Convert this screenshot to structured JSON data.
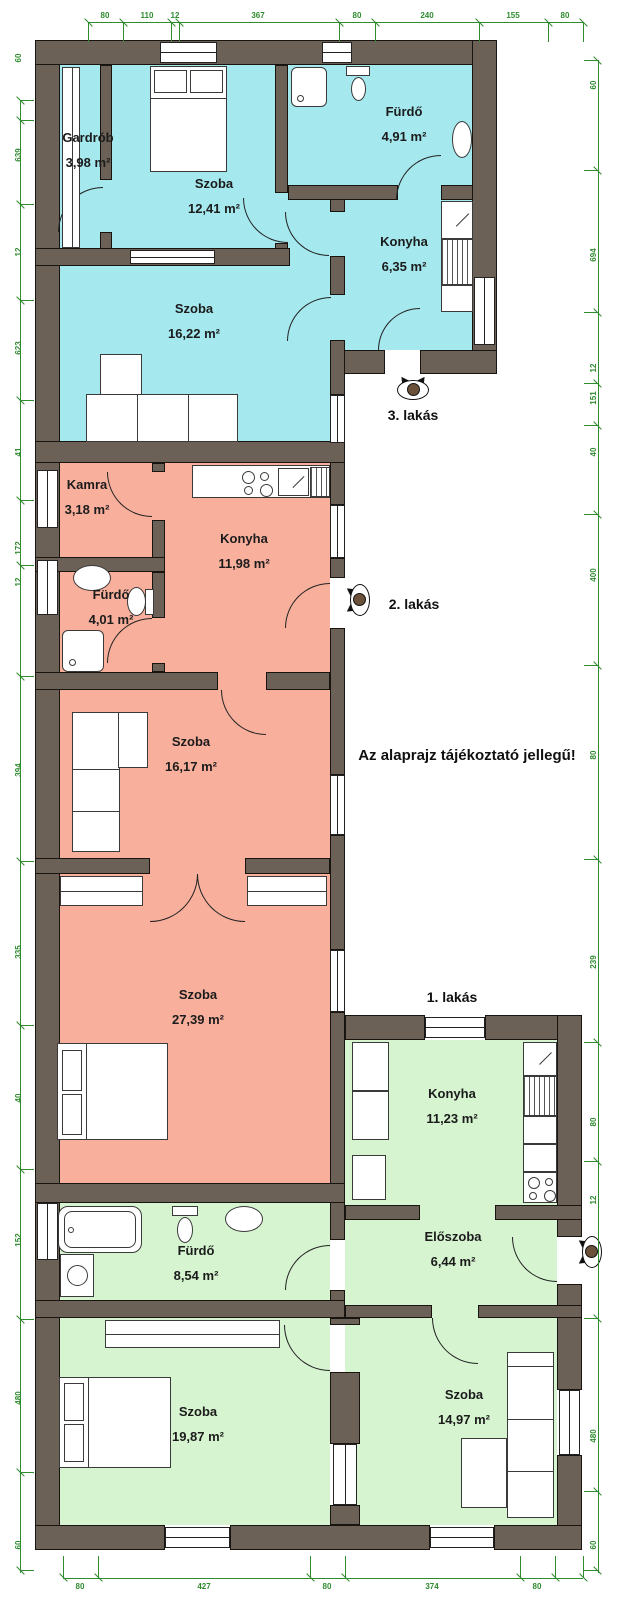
{
  "disclaimer": "Az alaprajz tájékoztató jellegű!",
  "apartments": [
    {
      "label": "1. lakás"
    },
    {
      "label": "2. lakás"
    },
    {
      "label": "3. lakás"
    }
  ],
  "rooms": [
    {
      "apartment": "3. lakás",
      "name": "Gardrób",
      "area": "3,98 m²"
    },
    {
      "apartment": "3. lakás",
      "name": "Szoba",
      "area": "12,41 m²"
    },
    {
      "apartment": "3. lakás",
      "name": "Fürdő",
      "area": "4,91 m²"
    },
    {
      "apartment": "3. lakás",
      "name": "Konyha",
      "area": "6,35 m²"
    },
    {
      "apartment": "3. lakás",
      "name": "Szoba",
      "area": "16,22 m²"
    },
    {
      "apartment": "2. lakás",
      "name": "Kamra",
      "area": "3,18 m²"
    },
    {
      "apartment": "2. lakás",
      "name": "Konyha",
      "area": "11,98 m²"
    },
    {
      "apartment": "2. lakás",
      "name": "Fürdő",
      "area": "4,01 m²"
    },
    {
      "apartment": "2. lakás",
      "name": "Szoba",
      "area": "16,17 m²"
    },
    {
      "apartment": "2. lakás",
      "name": "Szoba",
      "area": "27,39 m²"
    },
    {
      "apartment": "1. lakás",
      "name": "Konyha",
      "area": "11,23 m²"
    },
    {
      "apartment": "1. lakás",
      "name": "Előszoba",
      "area": "6,44 m²"
    },
    {
      "apartment": "1. lakás",
      "name": "Fürdő",
      "area": "8,54 m²"
    },
    {
      "apartment": "1. lakás",
      "name": "Szoba",
      "area": "19,87 m²"
    },
    {
      "apartment": "1. lakás",
      "name": "Szoba",
      "area": "14,97 m²"
    }
  ],
  "dims": {
    "top": [
      "80",
      "110",
      "12",
      "367",
      "80",
      "240",
      "155",
      "80"
    ],
    "bottom": [
      "80",
      "427",
      "80",
      "374",
      "80"
    ],
    "left": [
      "60",
      "639",
      "12",
      "623",
      "41",
      "172",
      "12",
      "394",
      "335",
      "40",
      "152",
      "480",
      "60"
    ],
    "right": [
      "60",
      "694",
      "12",
      "151",
      "40",
      "400",
      "80",
      "239",
      "80",
      "12",
      "480",
      "60"
    ]
  },
  "colors": {
    "apartment_1": "#d5f4cf",
    "apartment_2": "#f8b09d",
    "apartment_3": "#a5e8ee",
    "wall": "#6b6156",
    "dimension": "#2e8b2e"
  }
}
